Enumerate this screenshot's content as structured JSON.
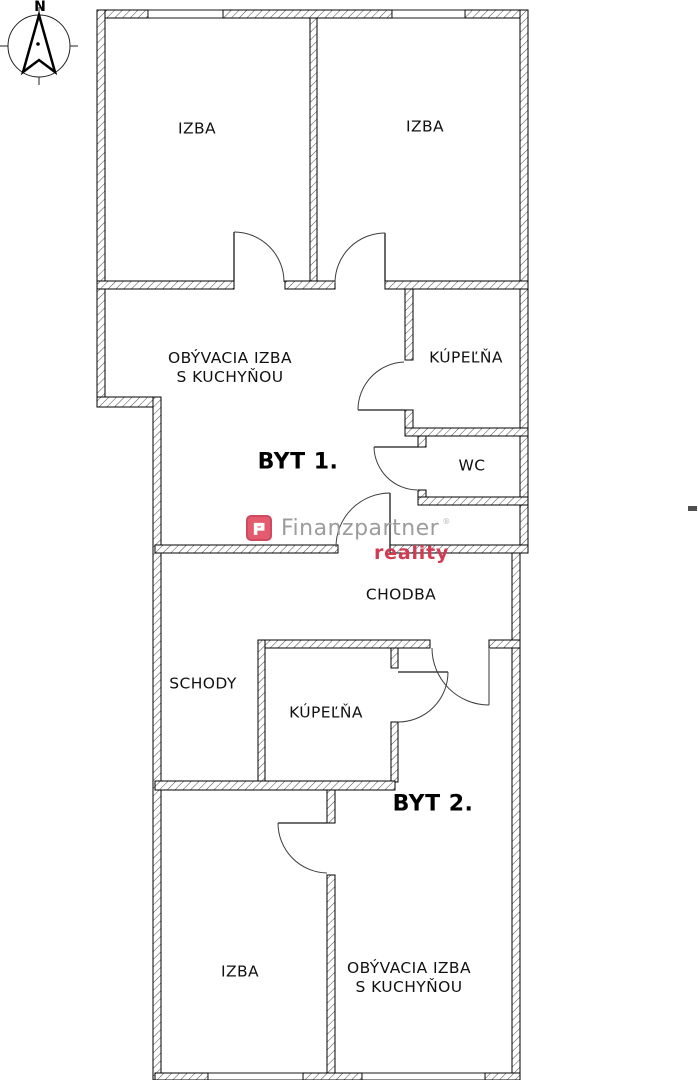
{
  "compass": {
    "north": "N"
  },
  "labels": {
    "izba_nw": "IZBA",
    "izba_ne": "IZBA",
    "obyvacia1_line1": "OBÝVACIA IZBA",
    "obyvacia1_line2": "S KUCHYŇOU",
    "kupelna1": "KÚPEĽŇA",
    "byt1": "BYT 1.",
    "wc": "WC",
    "chodba": "CHODBA",
    "schody": "SCHODY",
    "kupelna2": "KÚPEĽŇA",
    "byt2": "BYT 2.",
    "izba_s": "IZBA",
    "obyvacia2_line1": "OBÝVACIA IZBA",
    "obyvacia2_line2": "S KUCHYŇOU"
  },
  "watermark": {
    "brand": "Finanzpartner",
    "registered": "®",
    "subtitle": "reality",
    "brand_color": "#9c9c9c",
    "subtitle_color": "#d23b52",
    "badge_fill": "#e25b6e",
    "badge_border": "#cf4a5e"
  }
}
